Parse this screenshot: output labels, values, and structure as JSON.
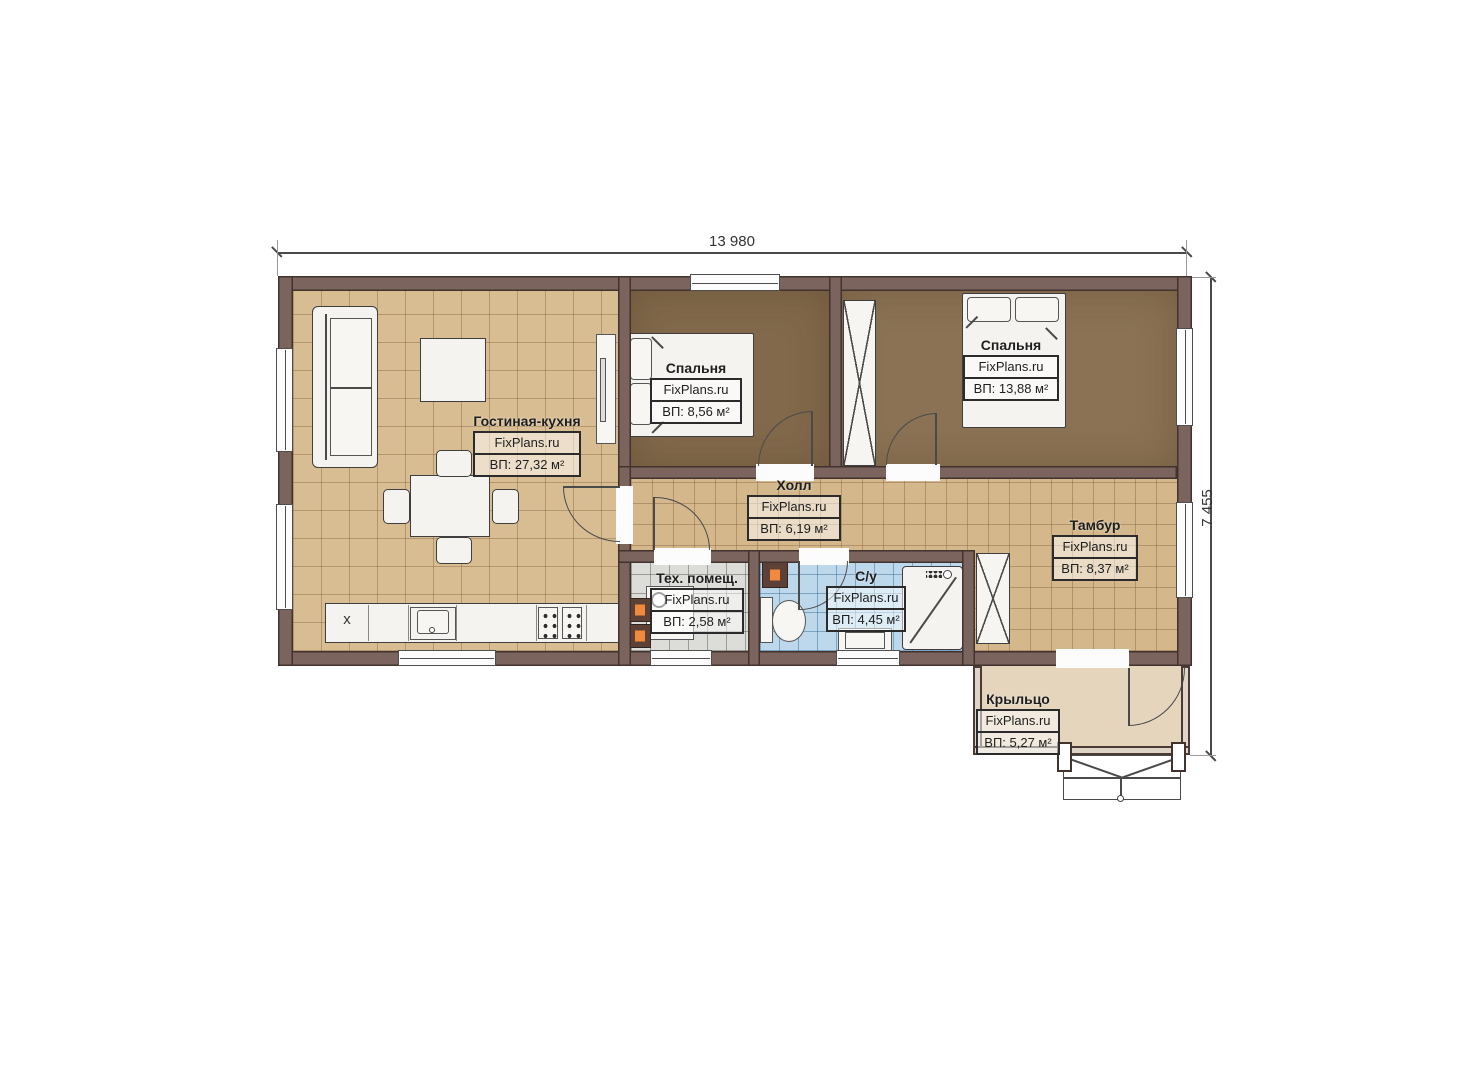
{
  "title": "План дома FixPlans.ru",
  "dimensions": {
    "width": "13 980",
    "height": "7 455"
  },
  "rooms": [
    {
      "name": "Гостиная-кухня",
      "brand": "FixPlans.ru",
      "area": "ВП: 27,32 м²"
    },
    {
      "name": "Спальня",
      "brand": "FixPlans.ru",
      "area": "ВП: 8,56 м²"
    },
    {
      "name": "Спальня",
      "brand": "FixPlans.ru",
      "area": "ВП: 13,88 м²"
    },
    {
      "name": "Холл",
      "brand": "FixPlans.ru",
      "area": "ВП: 6,19 м²"
    },
    {
      "name": "Тамбур",
      "brand": "FixPlans.ru",
      "area": "ВП: 8,37 м²"
    },
    {
      "name": "Тех. помещ.",
      "brand": "FixPlans.ru",
      "area": "ВП: 2,58 м²"
    },
    {
      "name": "С/у",
      "brand": "FixPlans.ru",
      "area": "ВП: 4,45 м²"
    },
    {
      "name": "Крыльцо",
      "brand": "FixPlans.ru",
      "area": "ВП: 5,27 м²"
    }
  ],
  "appliances": {
    "fridge_mark": "x"
  },
  "colors": {
    "wall": "#7b635e",
    "floor_living": "#d8bd93",
    "floor_bedroom": "#87704f",
    "floor_tech": "#dcdcd8",
    "floor_bath": "#bdd8ea",
    "floor_porch": "#e4d5bc",
    "accent_orange": "#f18a3d"
  }
}
